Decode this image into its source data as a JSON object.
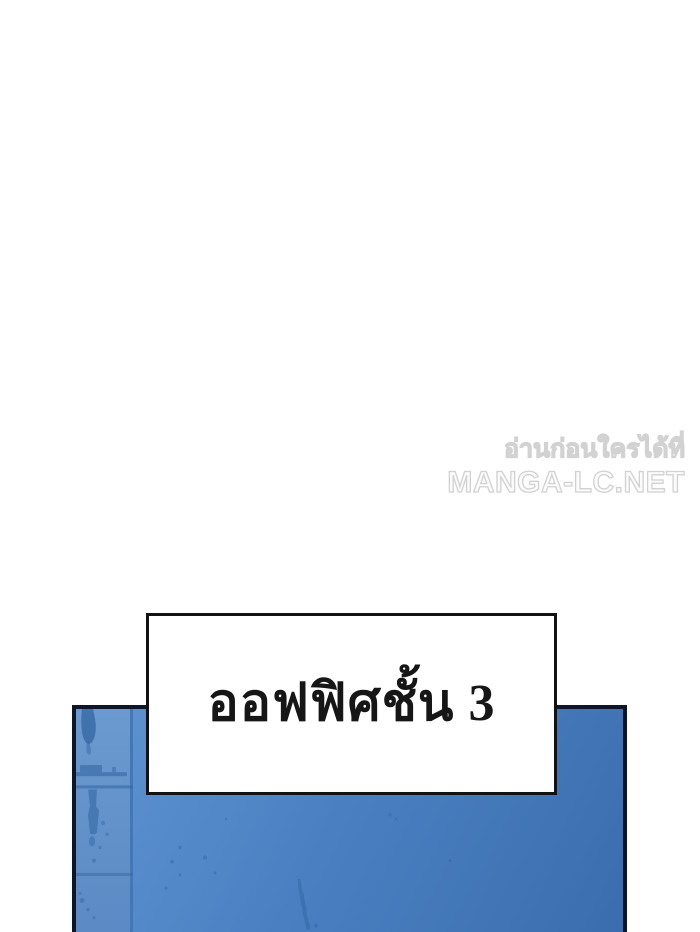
{
  "watermark": {
    "line1": "อ่านก่อนใครได้ที่",
    "line2": "MANGA-LC.NET"
  },
  "caption": {
    "text": "ออฟฟิศชั้น 3"
  },
  "colors": {
    "page_bg": "#ffffff",
    "watermark_fill": "#fbfbfb",
    "watermark_stroke": "#d2d2d2",
    "caption_border": "#121212",
    "caption_ink": "#161616",
    "panel_border": "#0d1526",
    "panel_light": "#6094d2",
    "panel_mid": "#4a80c2",
    "panel_dark": "#3a6dad",
    "strip_blue": "#6b9ad0",
    "strip_blue_dark": "#5b8ac4",
    "edge_blue": "#4477b6",
    "detail_blue": "#2f639f"
  }
}
